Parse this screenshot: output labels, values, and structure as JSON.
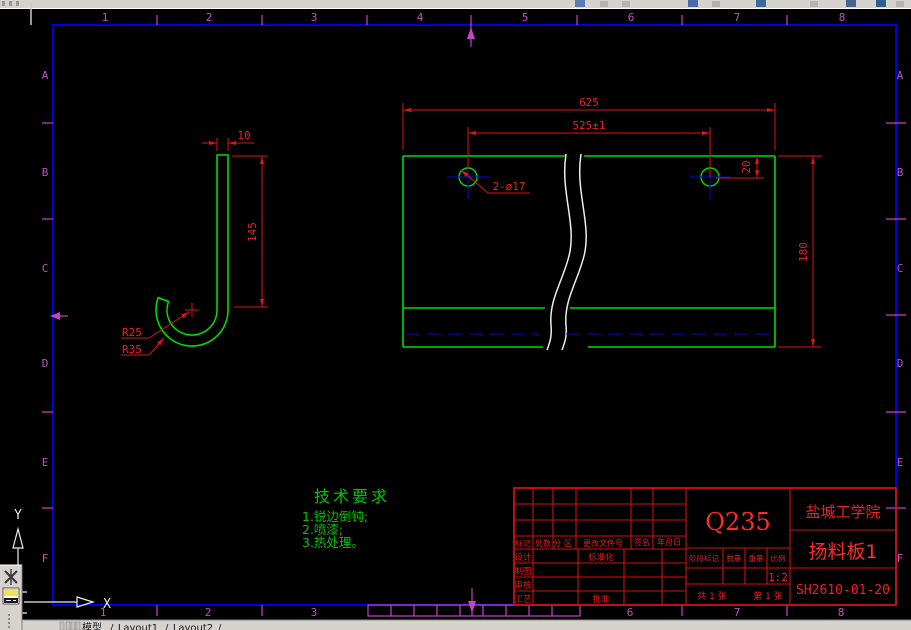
{
  "zones": {
    "cols": [
      "1",
      "2",
      "3",
      "4",
      "5",
      "6",
      "7",
      "8"
    ],
    "cols_bottom": [
      "1",
      "2",
      "3",
      "6",
      "7",
      "8"
    ],
    "rows": [
      "A",
      "B",
      "C",
      "D",
      "E",
      "F"
    ]
  },
  "hook_dims": {
    "width": "10",
    "height": "145",
    "radius_inner": "R25",
    "radius_outer": "R35"
  },
  "plate_dims": {
    "overall_width": "625",
    "hole_spacing": "525±1",
    "hole_offset": "20",
    "height": "180",
    "holes_callout": "2-ø17"
  },
  "tech_requirements": {
    "title": "技术要求",
    "items": [
      "1.锐边倒钝;",
      "2.喷漆;",
      "3.热处理。"
    ]
  },
  "title_block": {
    "material": "Q235",
    "organization": "盐城工学院",
    "part_name": "扬料板1",
    "drawing_number": "SH2610-01-20",
    "scale_value": "1:2",
    "sheet_total": "共 1 张",
    "sheet_page": "第 1 张",
    "labels": {
      "mark": "标记",
      "count": "处数",
      "zone": "分区",
      "change_file_no": "更改文件号",
      "signature": "签名",
      "date": "年月日",
      "design": "设计",
      "draft": "制图",
      "review": "审核",
      "process": "工艺",
      "standardization": "标准化",
      "approve": "批准",
      "stage_mark": "阶段标记",
      "quantity": "数量",
      "weight": "重量",
      "scale": "比例"
    }
  },
  "ucs": {
    "x_label": "X",
    "y_label": "Y"
  },
  "status_bar": {
    "model_tab": "模型",
    "layout1_tab": "Layout1",
    "layout2_tab": "Layout2",
    "separator": "/"
  },
  "colors": {
    "entity_green": "#00dc00",
    "dimension_red": "#e01212",
    "frame_blue": "#0000e0",
    "zone_magenta": "#bb55bb",
    "break_white": "#ededed",
    "ui_gray": "#d6d3ce"
  }
}
